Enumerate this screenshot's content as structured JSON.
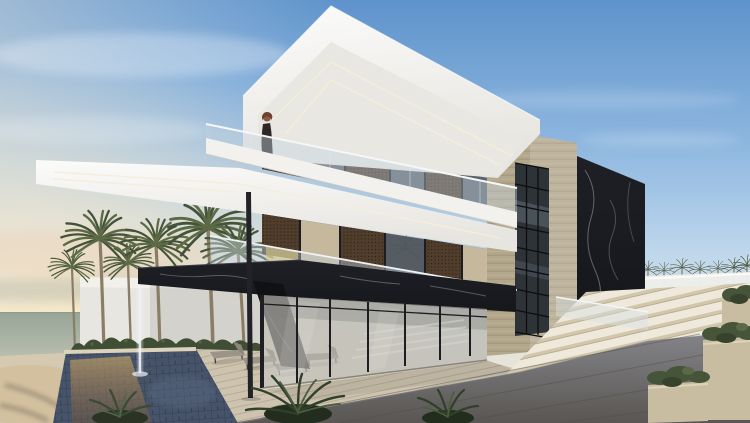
{
  "meta": {
    "description": "Sunset architectural rendering of a modern three-storey beachfront villa with cantilevered white slabs, black marble canopy, travertine tower, pool with fountain, palm trees and wide stone stairs",
    "width": 750,
    "height": 423
  },
  "palette": {
    "sky_top": "#5e93cb",
    "sky_mid": "#8fb8e0",
    "sky_low": "#bfd7ec",
    "horizon_warm": "#efe4cf",
    "sea_green": "#a9b2a4",
    "sand": "#d5cab1",
    "roof_white": "#f6f5f2",
    "soffit_white": "#e9e7e2",
    "fascia_white": "#f2f1ed",
    "led_warm": "#f6eeda",
    "band_dark": "#27221d",
    "mesh_bronze": "#503d2b",
    "glass_tint": "#6f7c8a",
    "curtain_beige": "#c6b89d",
    "yellow_glass": "#d6c783",
    "mullion_dark": "#1d1d21",
    "marble_black": "#16171b",
    "marble_vein": "#cfd2d6",
    "travertine": "#b3a78c",
    "travertine_light": "#c6bba1",
    "pool_tile": "#475368",
    "pool_warm": "#bf8f4e",
    "deck_wood": "#cdc3af",
    "paving_grey": "#85858a",
    "paving_dark": "#595653",
    "stair_tread": "#efe9dc",
    "stair_riser": "#d2c7ac",
    "planter_stone": "#c8bda1",
    "terrace_beige": "#d8cdb2",
    "shrub_green": "#46543a",
    "hedge_green": "#3f4e34",
    "palm_green": "#5c6b45",
    "palm_dark": "#44523a",
    "trunk_brown": "#8b7d65",
    "wall_white": "#e8e6e1",
    "backwall_white": "#f3f1ea",
    "column_dark": "#232327",
    "water_white": "#eef3f5",
    "figure_dark": "#2d2826",
    "scarf_brown": "#6e4030",
    "chair_grey": "#9a9489",
    "chair_grey_dark": "#8a847a"
  },
  "scene": {
    "time_of_day": "dusk / sunset",
    "sky": {
      "top": "clear blue",
      "horizon_left": "warm peach glow",
      "clouds": "soft hazy streaks"
    },
    "sea": {
      "position": "far left",
      "tone": "grey-green with pale reflections"
    },
    "villa": {
      "storeys": 3,
      "style": "contemporary cantilevered volumes",
      "materials": [
        "white plaster slabs",
        "black marble",
        "travertine stone",
        "clear glass balustrades",
        "bronze mesh screens"
      ],
      "features": [
        "deep cantilevered roof slab with recessed perimeter light lines",
        "glass-railing balconies on two floors",
        "black marble floor band folding into an angled canopy over the deck",
        "water jet pouring from the canopy tip into the pool",
        "travertine tower with full-height gridded window",
        "black marble feature wall on the right",
        "floor-to-ceiling ground-floor glazing with interior stair visible",
        "slender dark steel support column"
      ]
    },
    "figure": {
      "description": "woman in dark abaya with brown headscarf standing at the top-floor balcony"
    },
    "landscape": {
      "palms_left": 6,
      "palms_right": "row of small distant palms above a white wall",
      "pool": "dark blue mosaic tiles with golden sunset reflections",
      "fountain": "single thin water jet",
      "deck": "light timber with four grey sun loungers",
      "stairs": "wide beige stone steps ascending right",
      "planters": 3,
      "foreground": "dark concrete paving with fern clusters",
      "hedge": "low green hedge along the white garden wall"
    }
  }
}
